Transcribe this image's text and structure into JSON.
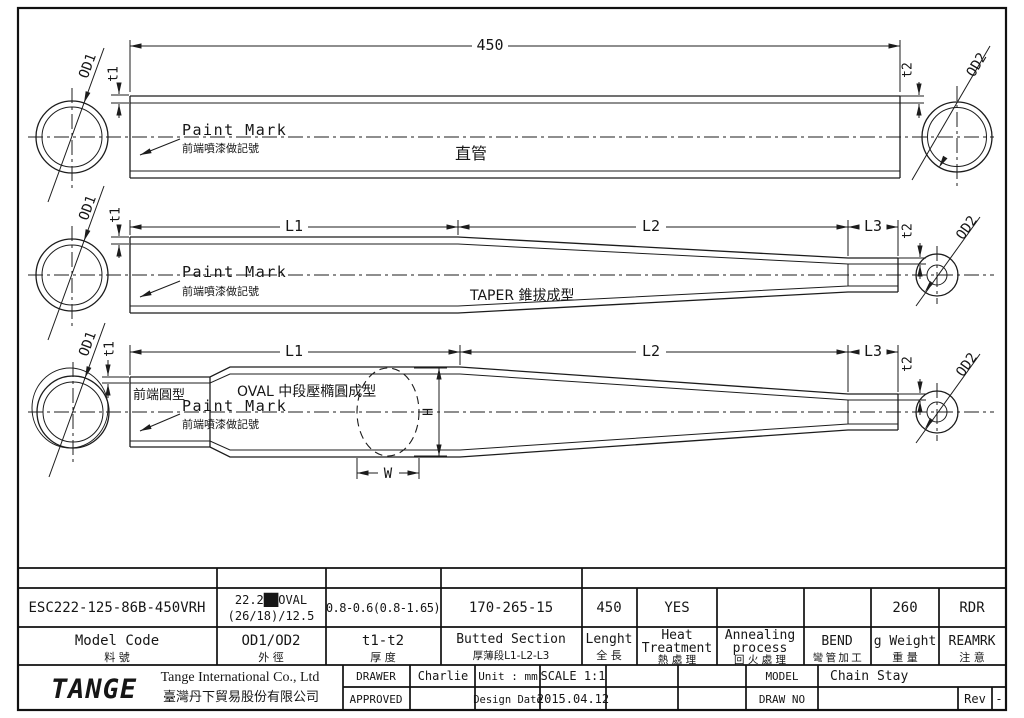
{
  "colors": {
    "line": "#1c1c1c",
    "logo_green": "#2f9e39"
  },
  "drawing1": {
    "length_dim": "450",
    "od1": "OD1",
    "od2": "OD2",
    "t1": "t1",
    "t2": "t2",
    "paint_mark": "Paint Mark",
    "paint_mark_zh": "前端噴漆做記號",
    "type_zh": "直管"
  },
  "drawing2": {
    "l1": "L1",
    "l2": "L2",
    "l3": "L3",
    "od1": "OD1",
    "od2": "OD2",
    "t1": "t1",
    "t2": "t2",
    "paint_mark": "Paint Mark",
    "paint_mark_zh": "前端噴漆做記號",
    "type_label": "TAPER 錐拔成型"
  },
  "drawing3": {
    "l1": "L1",
    "l2": "L2",
    "l3": "L3",
    "od1": "OD1",
    "od2": "OD2",
    "t1": "t1",
    "t2": "t2",
    "front_zh": "前端圓型",
    "type_label": "OVAL 中段壓橢圓成型",
    "paint_mark": "Paint Mark",
    "paint_mark_zh": "前端噴漆做記號",
    "w": "W",
    "h": "H"
  },
  "spec_table": {
    "cols": [
      {
        "h": "Model Code",
        "hz": "料 號",
        "v": "ESC222-125-86B-450VRH"
      },
      {
        "h": "OD1/OD2",
        "hz": "外 徑",
        "v1": "22.2██OVAL",
        "v2": "(26/18)/12.5"
      },
      {
        "h": "t1-t2",
        "hz": "厚 度",
        "v": "0.8-0.6(0.8-1.65)"
      },
      {
        "h": "Butted Section",
        "hz": "厚薄段L1-L2-L3",
        "v": "170-265-15"
      },
      {
        "h": "Lenght",
        "hz": "全 長",
        "v": "450"
      },
      {
        "h1": "Heat",
        "h2": "Treatment",
        "hz": "熱 處 理",
        "v": "YES"
      },
      {
        "h1": "Annealing",
        "h2": "process",
        "hz": "回 火 處 理",
        "v": ""
      },
      {
        "h": "BEND",
        "hz": "彎 管 加 工",
        "v": ""
      },
      {
        "h": "g Weight",
        "hz": "重 量",
        "v": "260"
      },
      {
        "h": "REAMRK",
        "hz": "注 意",
        "v": "RDR"
      }
    ]
  },
  "title_block": {
    "logo": "TANGE",
    "company_en": "Tange International Co., Ltd",
    "company_zh": "臺灣丹下貿易股份有限公司",
    "drawer_label": "DRAWER",
    "drawer": "Charlie",
    "approved_label": "APPROVED",
    "approved": "",
    "unit_label": "Unit : mm",
    "scale": "SCALE 1:1",
    "design_date_label": "Design Date",
    "design_date": "2015.04.12",
    "model_label": "MODEL",
    "model": "Chain Stay",
    "drawno_label": "DRAW NO",
    "drawno": "",
    "rev_label": "Rev",
    "rev": "-"
  }
}
